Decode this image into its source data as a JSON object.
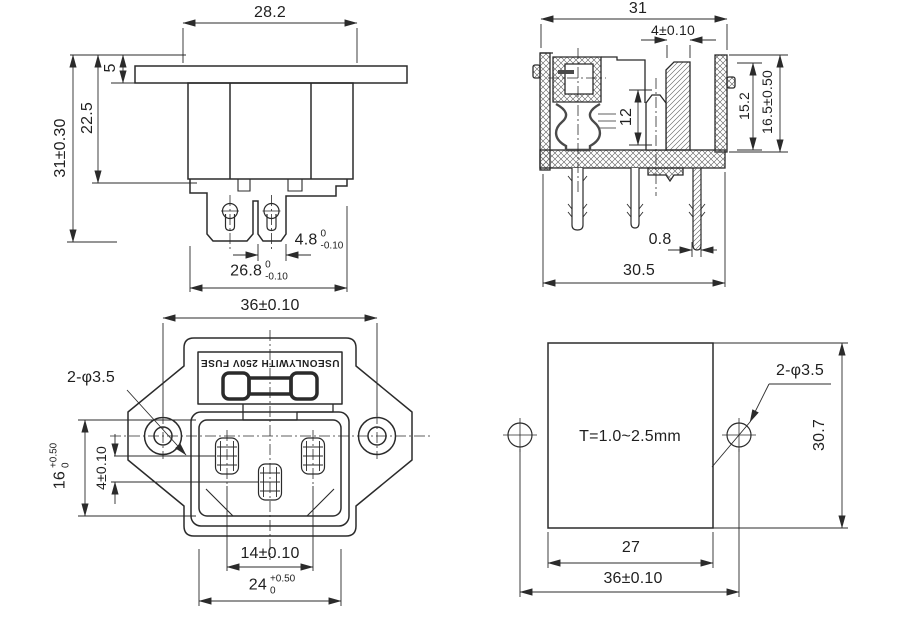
{
  "drawing": {
    "line_color": "#2b2b2b",
    "views": {
      "side": {
        "dims": {
          "top_width": "28.2",
          "flange_thickness": "5",
          "body_depth": "22.5",
          "overall_depth": "31±0.30",
          "terminal_width": {
            "value": "4.8",
            "tol_top": "0",
            "tol_bot": "-0.10"
          },
          "lower_width": {
            "value": "26.8",
            "tol_top": "0",
            "tol_bot": "-0.10"
          }
        }
      },
      "section": {
        "dims": {
          "top_width": "31",
          "rib_width": "4±0.10",
          "contact_length": "12",
          "cavity_depth": "15.2",
          "overall_height": "16.5±0.50",
          "leg_thickness": "0.8",
          "bottom_width": "30.5"
        }
      },
      "front": {
        "marking": "USEONLYWITH 250V FUSE",
        "dims": {
          "hole_spacing": "36±0.10",
          "mounting_holes": "2-φ3.5",
          "opening_height": {
            "value": "16",
            "tol_top": "+0.50",
            "tol_bot": "0"
          },
          "earth_offset": "4±0.10",
          "pin_spacing": "14±0.10",
          "opening_width": {
            "value": "24",
            "tol_top": "+0.50",
            "tol_bot": "0"
          }
        }
      },
      "cutout": {
        "note": "T=1.0~2.5mm",
        "dims": {
          "mounting_holes": "2-φ3.5",
          "height": "30.7",
          "width": "27",
          "hole_spacing": "36±0.10"
        }
      }
    }
  }
}
